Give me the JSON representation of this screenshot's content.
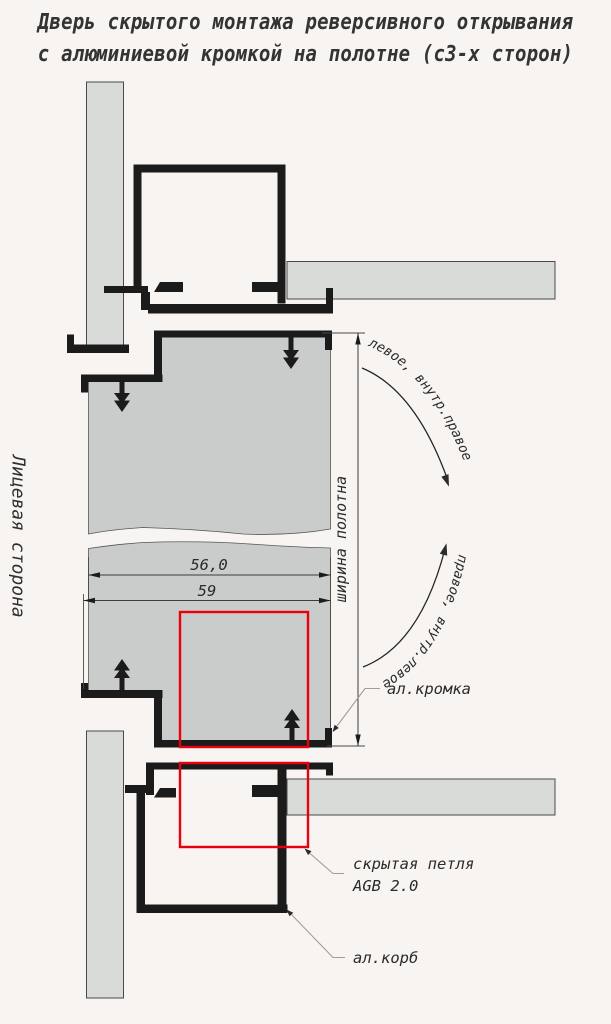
{
  "title": {
    "line1": "Дверь скрытого монтажа реверсивного открывания",
    "line2": "с алюминиевой кромкой на полотне (с3-х сторон)"
  },
  "side_label": "Лицевая сторона",
  "dimensions": {
    "panel_width_value": "56,0",
    "overall_width_value": "59",
    "panel_width_label": "ширина полотна"
  },
  "swing_labels": {
    "upper": "левое, внутр.правое",
    "lower": "правое, внутр.левое"
  },
  "callouts": {
    "edge": "ал.кромка",
    "hinge_line1": "скрытая петля",
    "hinge_line2": "AGB 2.0",
    "frame": "ал.корб"
  },
  "colors": {
    "background": "#f8f4f1",
    "wall_fill": "#d9dbd9",
    "panel_fill": "#c9ccca",
    "profile_black": "#1b1b1b",
    "hinge_highlight_red": "#e8000d",
    "leader_gray": "#a39d99",
    "text": "#2b2b2b"
  }
}
